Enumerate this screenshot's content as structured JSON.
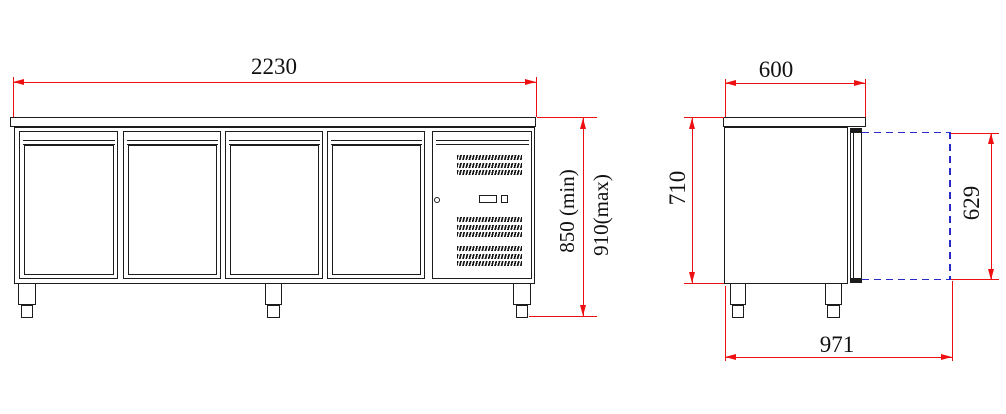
{
  "drawing": {
    "views": {
      "front": "front-elevation",
      "side": "side-elevation"
    },
    "front_view": {
      "door_count": 4,
      "width_dim": "2230",
      "height_dim_min": "850 (min)",
      "height_dim_max": "910(max)"
    },
    "side_view": {
      "top_depth_dim": "600",
      "body_height_dim": "710",
      "door_open_dim": "629",
      "overall_depth_dim": "971"
    },
    "colors": {
      "outline": "#1c1c1c",
      "dimension_lines": "#ee1010",
      "door_swing_dashed": "#2a2ac8",
      "background": "#ffffff",
      "text": "#111111"
    },
    "icons": {
      "vent_grille": "diagonal-hatch-band",
      "lock": "small-circle-keyhole",
      "control_cutout": "rectangle-and-square"
    }
  }
}
